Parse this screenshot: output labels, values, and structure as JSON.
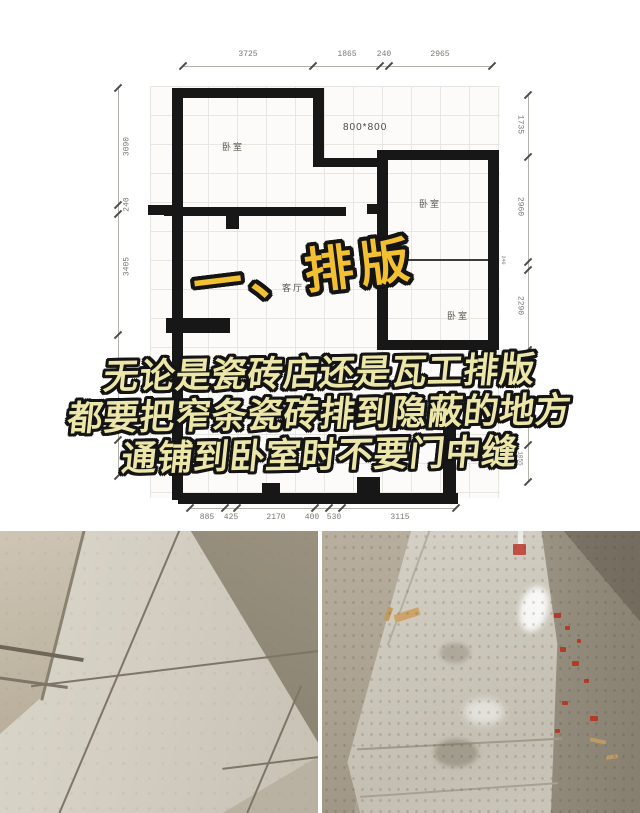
{
  "page": {
    "background": "#ffffff"
  },
  "overlay": {
    "title": "一、排版",
    "lines": [
      "无论是瓷砖店还是瓦工排版",
      "都要把窄条瓷砖排到隐蔽的地方",
      "通铺到卧室时不要门中缝"
    ],
    "title_color": "#f2c031",
    "body_color": "#ece6a8",
    "outline_color": "#141414"
  },
  "floor_plan": {
    "tile_size_note": "800*800",
    "room_labels": {
      "bedroom_top_left": "卧室",
      "bedroom_right": "卧室",
      "living_room": "客厅",
      "bedroom_bottom_right": "卧室",
      "dry_area": "干区"
    },
    "dimensions": {
      "top": [
        "3725",
        "1865",
        "240",
        "2965"
      ],
      "left": [
        "3090",
        "240",
        "3405",
        "1015"
      ],
      "right": [
        "1735",
        "2960",
        "240",
        "2290",
        "1055"
      ],
      "bottom": [
        "885",
        "425",
        "2170",
        "400",
        "530",
        "3115"
      ]
    }
  }
}
